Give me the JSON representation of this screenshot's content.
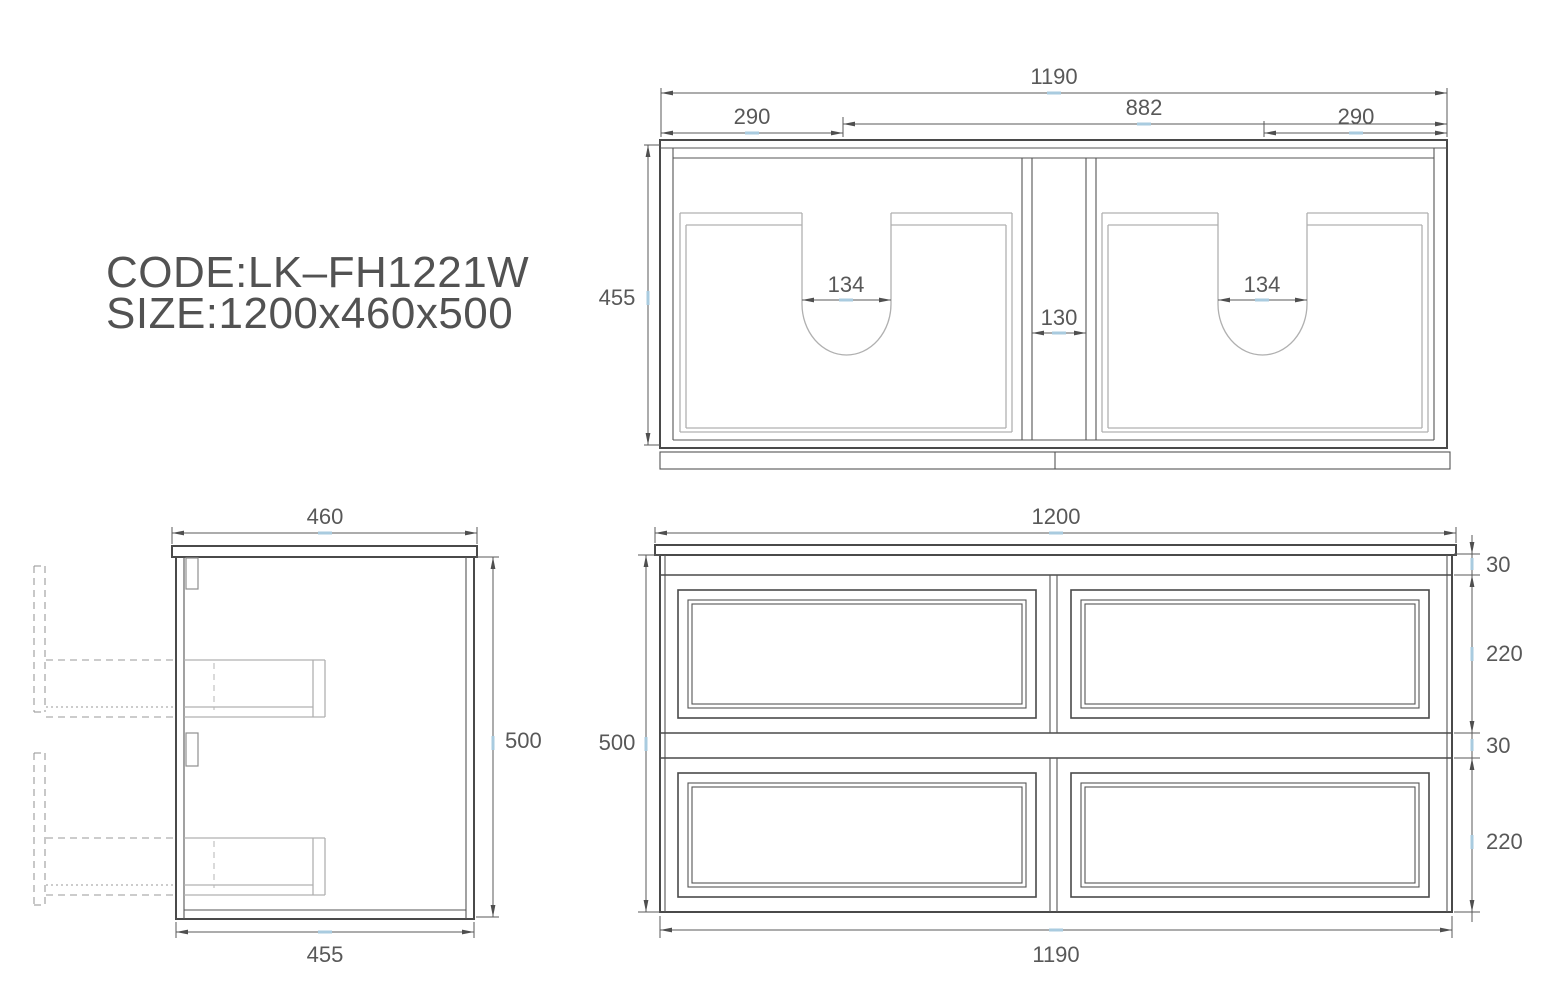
{
  "product": {
    "code": "CODE:LK–FH1221W",
    "size": "SIZE:1200x460x500"
  },
  "top_view": {
    "overall_width": "1190",
    "left_offset": "290",
    "center_span": "882",
    "right_offset": "290",
    "depth": "455",
    "left_cutout_width": "134",
    "right_cutout_width": "134",
    "center_gap": "130"
  },
  "side_view": {
    "top_depth": "460",
    "height": "500",
    "bottom_depth": "455"
  },
  "front_view": {
    "top_width": "1200",
    "height": "500",
    "bottom_width": "1190",
    "top_rail_height": "30",
    "upper_drawer_height": "220",
    "middle_rail_height": "30",
    "lower_drawer_height": "220"
  },
  "colors": {
    "outline": "#4a4a4a",
    "panel_gray": "#b0b0b0",
    "dimension": "#5a5a5a",
    "text": "#525252",
    "highlight_tick": "#a9cbdf"
  }
}
